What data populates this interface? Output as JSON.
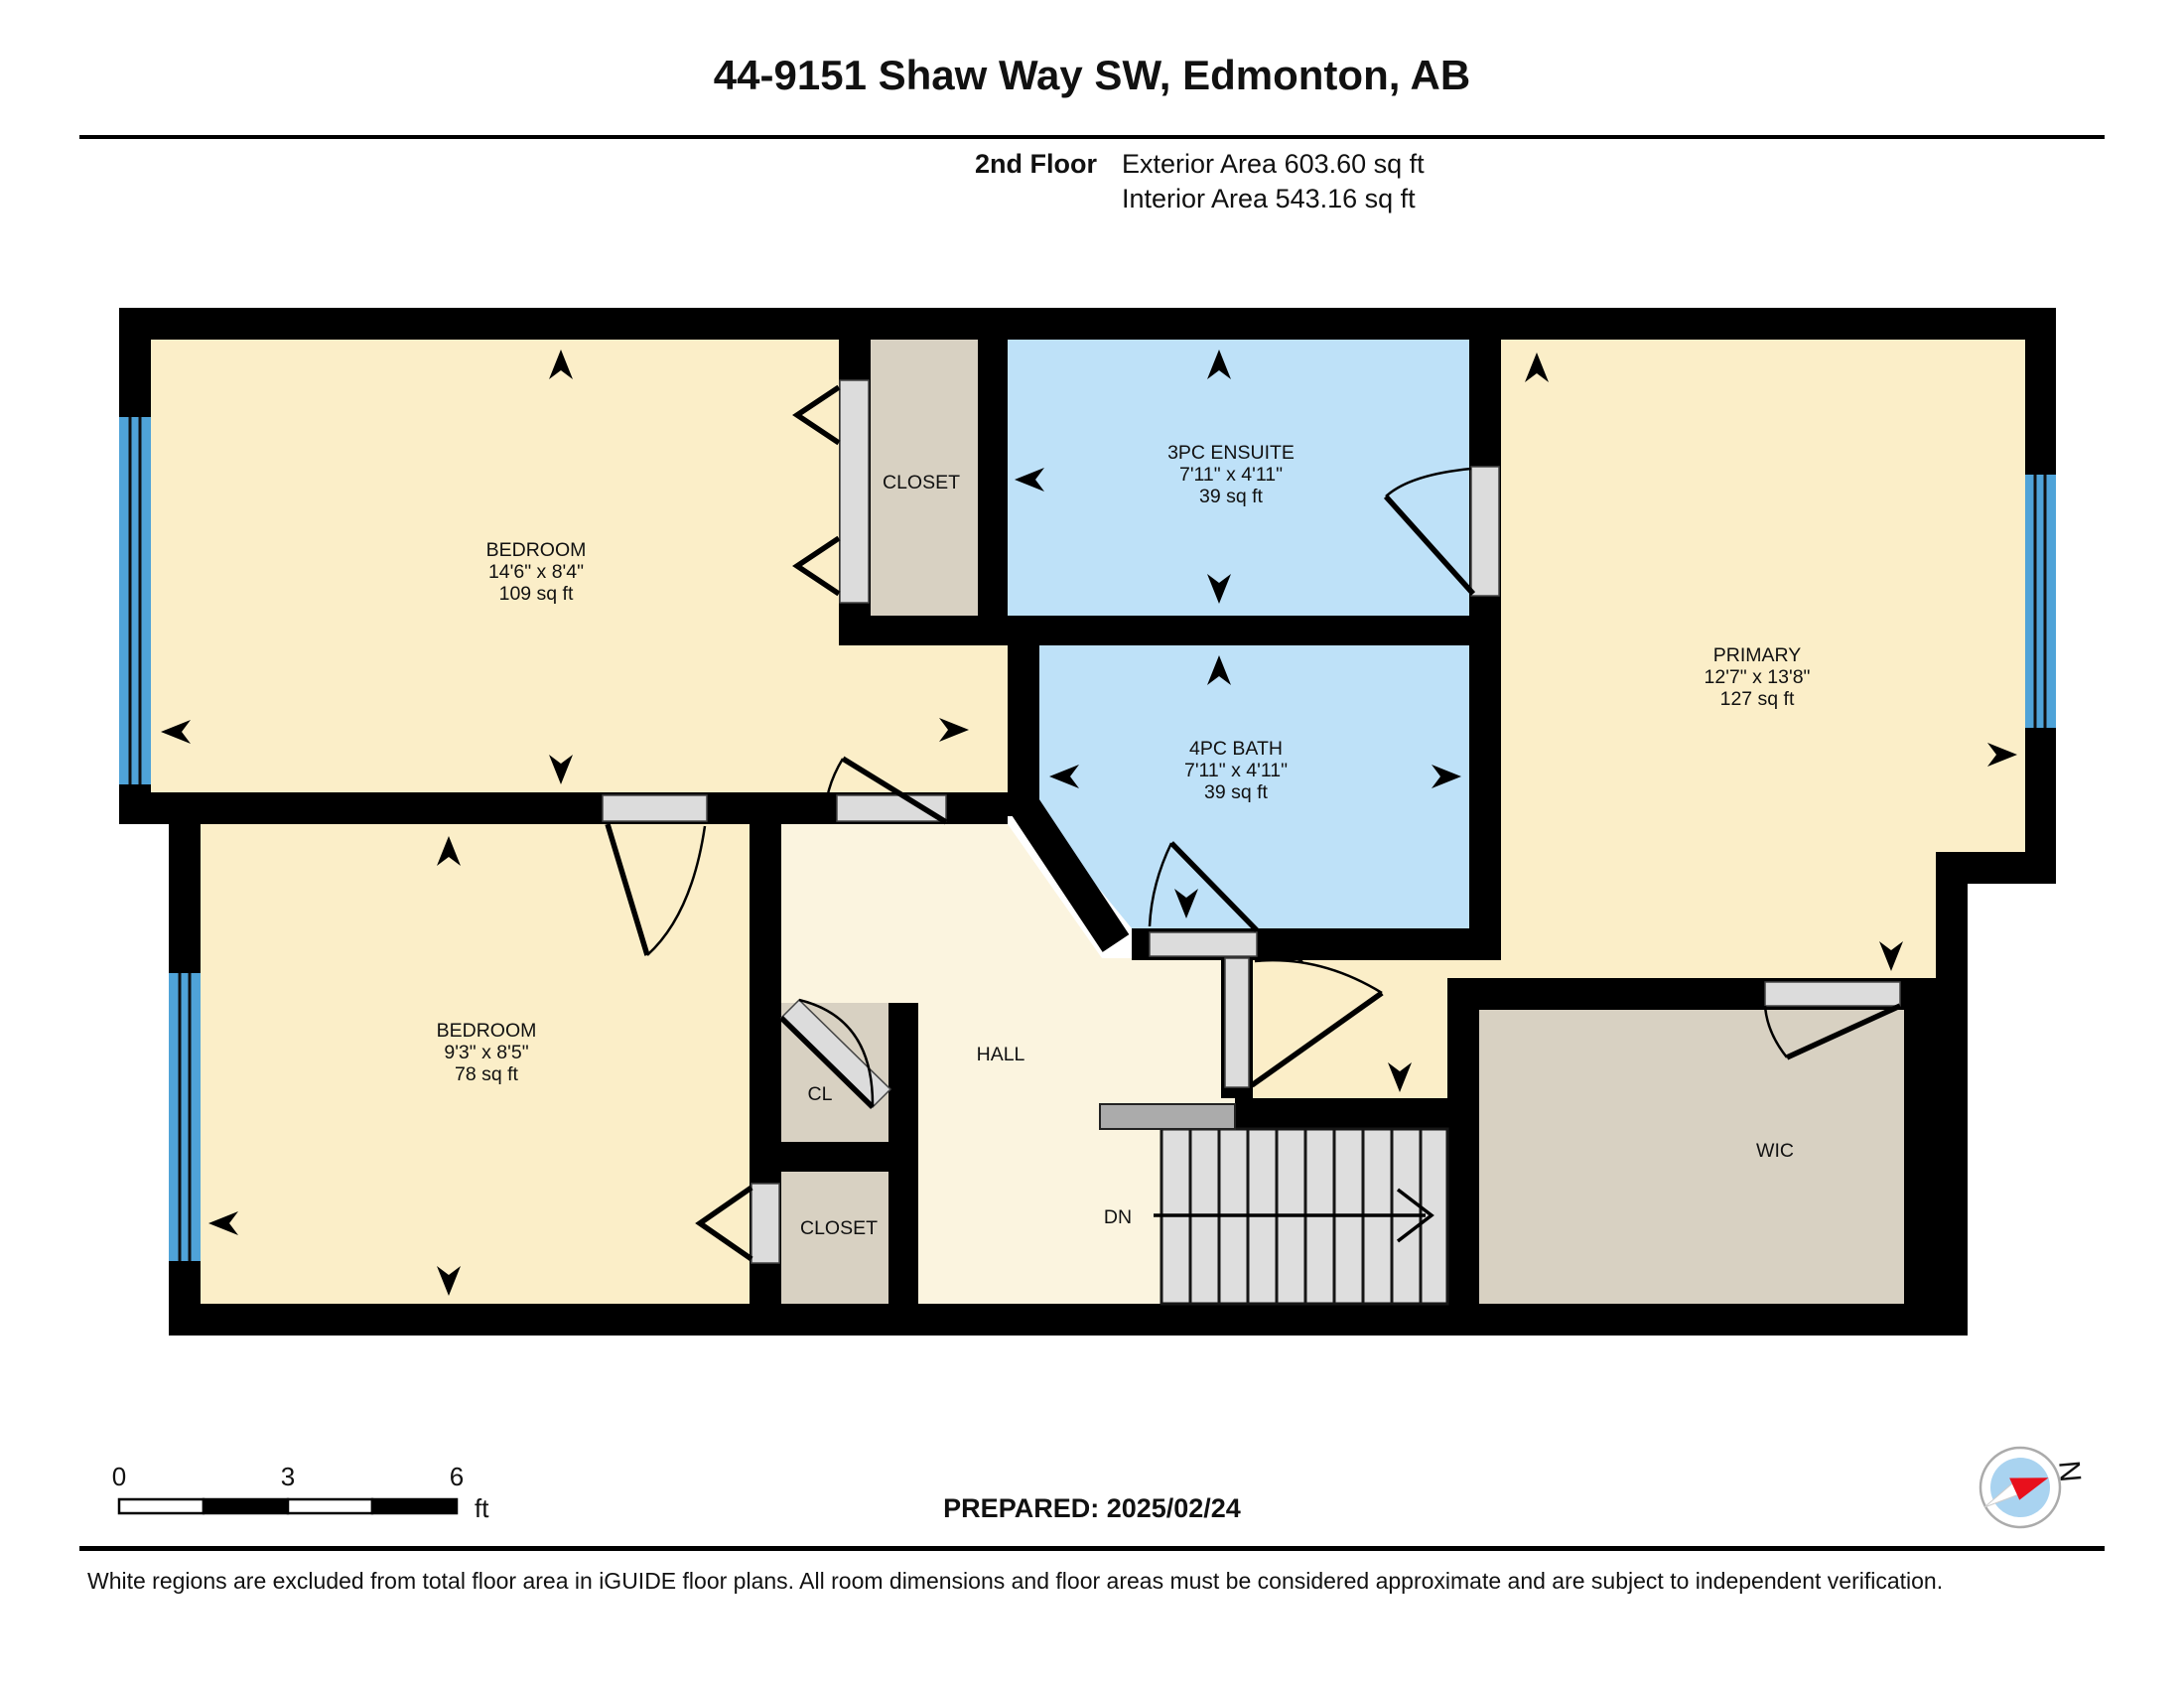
{
  "header": {
    "title": "44-9151 Shaw Way SW, Edmonton, AB",
    "floor_label": "2nd Floor",
    "exterior_area": "Exterior Area 603.60 sq ft",
    "interior_area": "Interior Area 543.16 sq ft"
  },
  "rooms": {
    "bedroom1": {
      "name": "BEDROOM",
      "dims": "14'6\" x 8'4\"",
      "area": "109 sq ft"
    },
    "closet_top": {
      "name": "CLOSET"
    },
    "ensuite": {
      "name": "3PC ENSUITE",
      "dims": "7'11\" x 4'11\"",
      "area": "39 sq ft"
    },
    "primary": {
      "name": "PRIMARY",
      "dims": "12'7\" x 13'8\"",
      "area": "127 sq ft"
    },
    "bath": {
      "name": "4PC BATH",
      "dims": "7'11\" x 4'11\"",
      "area": "39 sq ft"
    },
    "bedroom2": {
      "name": "BEDROOM",
      "dims": "9'3\" x 8'5\"",
      "area": "78 sq ft"
    },
    "hall": {
      "name": "HALL"
    },
    "cl": {
      "name": "CL"
    },
    "closet_lower": {
      "name": "CLOSET"
    },
    "wic": {
      "name": "WIC"
    },
    "stairs": {
      "label": "DN"
    }
  },
  "scale_bar": {
    "tick0": "0",
    "tick1": "3",
    "tick2": "6",
    "unit": "ft"
  },
  "compass": {
    "north_label": "N"
  },
  "footer": {
    "prepared": "PREPARED: 2025/02/24",
    "disclaimer": "White regions are excluded from total floor area in iGUIDE floor plans. All room dimensions and floor areas must be considered approximate and are subject to independent verification."
  },
  "colors": {
    "wall": "#000000",
    "room_cream": "#FBEEC8",
    "hall_cream": "#FBF4DF",
    "wet_blue": "#BEE1F8",
    "closet_tan": "#D8D1C2",
    "window_blue": "#4FA3D8",
    "door_grey": "#DCDCDC",
    "stair_grey": "#DEDEDE",
    "landing_grey": "#ABABAB",
    "compass_red": "#E8101C",
    "compass_blue": "#A9D3F0"
  }
}
